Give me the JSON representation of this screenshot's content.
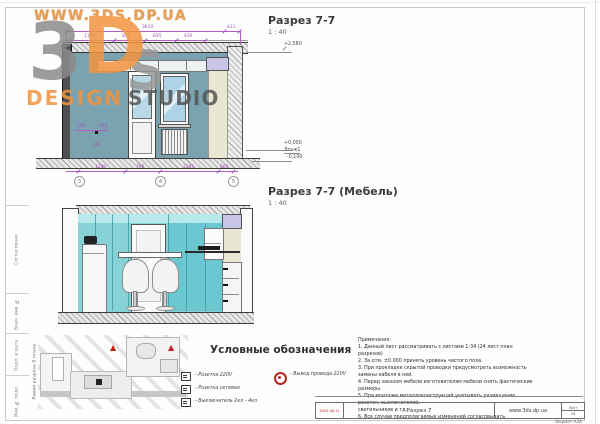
{
  "watermark": {
    "url": "WWW.3DS.DP.UA",
    "letter_3": "3",
    "letter_d": "D",
    "letter_s": "S",
    "design": "DESIGN",
    "studio": "STUDIO"
  },
  "drawing_section": {
    "title": "Разрез 7-7",
    "scale": "1 : 40",
    "elevation_top": "+2,580",
    "elevation_zero": "+0,000",
    "floor_label": "Этаж1",
    "elevation_below": "-0,100",
    "dims_top": [
      "3610",
      "411"
    ],
    "dims_mid": [
      "1140",
      "835",
      "835",
      "430"
    ],
    "dims_wall": [
      "540",
      "830",
      "90"
    ],
    "dims_bottom": [
      "1280",
      "790",
      "1285",
      "600"
    ],
    "grid": [
      "3",
      "4",
      "5"
    ]
  },
  "drawing_furniture": {
    "title": "Разрез 7-7 (Мебель)",
    "scale": "1 : 40"
  },
  "plan_strip": {
    "label": "Линия разреза В плане"
  },
  "legend": {
    "title": "Условные обозначения",
    "items": [
      "- Розетка 220V",
      "- Розетка сетевая",
      "- Выключатель 2кл - 4кл"
    ],
    "wire_label": "- Вывод провода 220V"
  },
  "notes": {
    "title": "Примечания:",
    "lines": [
      "1. Данный лист рассматривать с листами 1-34 (24 лист план разрезов)",
      "2. За отм. ±0.000 принять уровень чистого пола.",
      "3. При прокладке скрытой проводки предусмотреть возможность замены кабеля в ней.",
      "4. Перед заказом мебели изготовителям мебели снять фактические размеры.",
      "5. При монтаже металлоконструкций учитывать размещение розеток, выключателей,",
      "светильников и тд.",
      "6. Все случаи предполагаемых изменений согласовывать."
    ]
  },
  "stamp": {
    "cells": [
      "Согласовано",
      "Взам. инв. №",
      "Подп. и дата",
      "Инв. № подл."
    ]
  },
  "titleblock": {
    "date": "2020.06.11",
    "doc_title": "Разрез 7",
    "website": "www.3ds.dp.ua",
    "sheet_label": "Лист",
    "sheet_number": "24",
    "format_label": "Формат А3А"
  },
  "colors": {
    "wall_teal": "#7ba3af",
    "glass_turquoise": "#86d2d6",
    "dimension_magenta": "#a34fc0",
    "accent_red": "#b5261e",
    "logo_orange": "#f2943f",
    "logo_gray": "#8b8b8b"
  }
}
